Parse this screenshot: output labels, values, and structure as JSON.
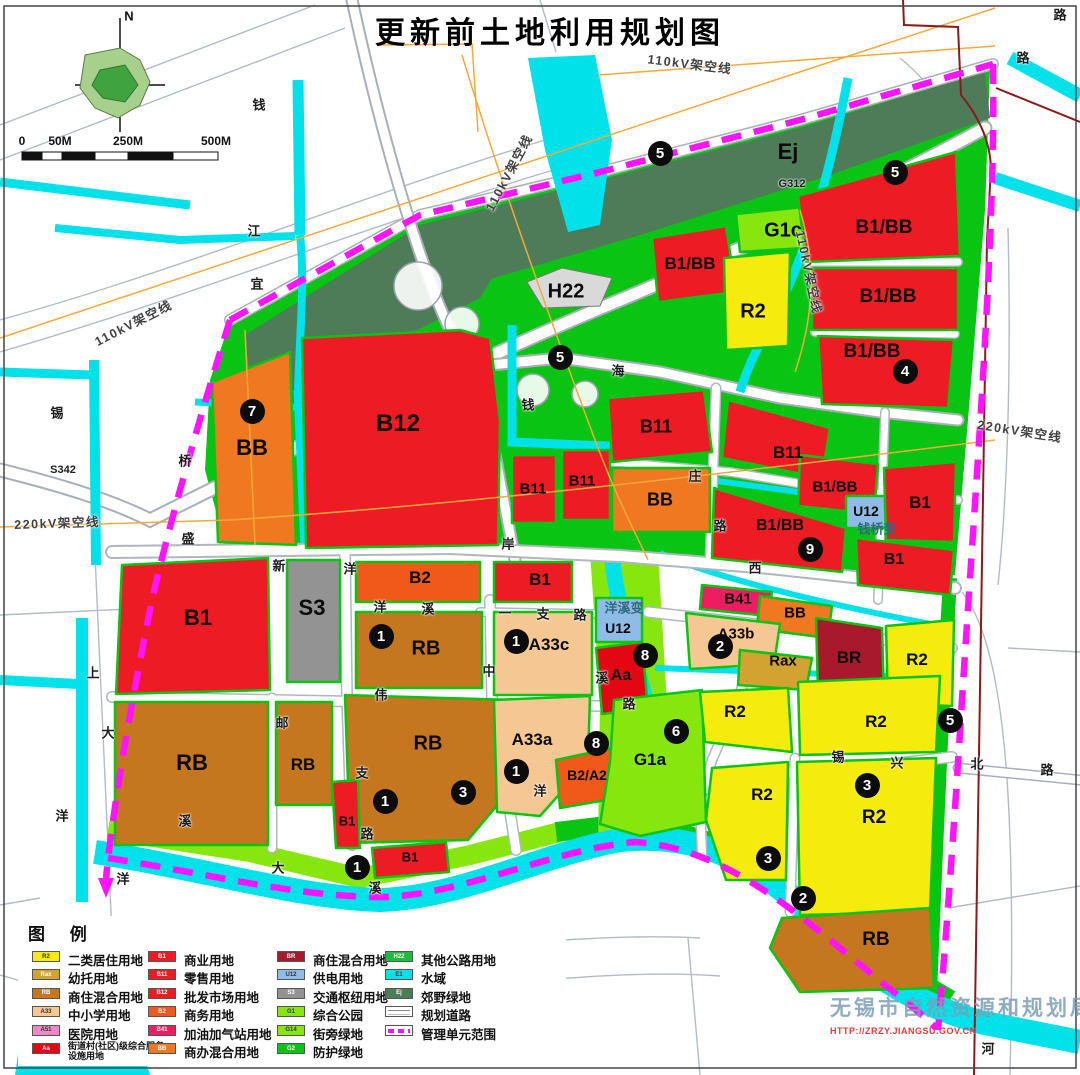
{
  "title": "更新前土地利用规划图",
  "compass": {
    "north_label": "N"
  },
  "scale_bar": {
    "ticks": [
      {
        "t": "0",
        "x": 22
      },
      {
        "t": "50M",
        "x": 60
      },
      {
        "t": "250M",
        "x": 128
      },
      {
        "t": "500M",
        "x": 216
      }
    ]
  },
  "legend": {
    "title": "图 例",
    "columns": [
      [
        {
          "code": "R2",
          "color": "#F5EB0C",
          "tc": "#333",
          "label": "二类居住用地"
        },
        {
          "code": "Rax",
          "color": "#D2A331",
          "tc": "#fff",
          "label": "幼托用地"
        },
        {
          "code": "RB",
          "color": "#C4771E",
          "tc": "#fff",
          "label": "商住混合用地"
        },
        {
          "code": "A33",
          "color": "#F5C793",
          "tc": "#333",
          "label": "中小学用地"
        },
        {
          "code": "A51",
          "color": "#F287C7",
          "tc": "#333",
          "label": "医院用地"
        },
        {
          "code": "Aa",
          "color": "#E30613",
          "tc": "#fff",
          "label": "街道村(社区)级综合服务设施用地",
          "small": true
        }
      ],
      [
        {
          "code": "B1",
          "color": "#ED1C24",
          "tc": "#fff",
          "label": "商业用地"
        },
        {
          "code": "B11",
          "color": "#ED1C24",
          "tc": "#fff",
          "label": "零售用地"
        },
        {
          "code": "B12",
          "color": "#ED1C24",
          "tc": "#fff",
          "label": "批发市场用地"
        },
        {
          "code": "B2",
          "color": "#F1591A",
          "tc": "#fff",
          "label": "商务用地"
        },
        {
          "code": "B41",
          "color": "#EE1D62",
          "tc": "#fff",
          "label": "加油加气站用地"
        },
        {
          "code": "BB",
          "color": "#F07820",
          "tc": "#fff",
          "label": "商办混合用地"
        }
      ],
      [
        {
          "code": "BR",
          "color": "#A8192E",
          "tc": "#fff",
          "label": "商住混合用地"
        },
        {
          "code": "U12",
          "color": "#8FBCE6",
          "tc": "#333",
          "label": "供电用地"
        },
        {
          "code": "S3",
          "color": "#939393",
          "tc": "#fff",
          "label": "交通枢纽用地"
        },
        {
          "code": "G1",
          "color": "#86E60D",
          "tc": "#333",
          "label": "综合公园"
        },
        {
          "code": "G14",
          "color": "#86E60D",
          "tc": "#333",
          "label": "街旁绿地"
        },
        {
          "code": "G2",
          "color": "#0AC414",
          "tc": "#fff",
          "label": "防护绿地"
        }
      ],
      [
        {
          "code": "H22",
          "color": "#1DBE3C",
          "tc": "#fff",
          "label": "其他公路用地"
        },
        {
          "code": "E1",
          "color": "#00E1EA",
          "tc": "#333",
          "label": "水域"
        },
        {
          "code": "Ej",
          "color": "#4E7B58",
          "tc": "#fff",
          "label": "郊野绿地"
        },
        {
          "type": "road",
          "code": "",
          "label": "规划道路"
        },
        {
          "type": "boundary",
          "code": "",
          "label": "管理单元范围"
        }
      ]
    ]
  },
  "map": {
    "zone_labels": [
      {
        "t": "Ej",
        "x": 788,
        "y": 152,
        "s": 22
      },
      {
        "t": "G1c",
        "x": 783,
        "y": 231,
        "s": 20
      },
      {
        "t": "B1/BB",
        "x": 690,
        "y": 264,
        "s": 17
      },
      {
        "t": "R2",
        "x": 753,
        "y": 312,
        "s": 20
      },
      {
        "t": "B1/BB",
        "x": 884,
        "y": 228,
        "s": 19
      },
      {
        "t": "B1/BB",
        "x": 888,
        "y": 297,
        "s": 19
      },
      {
        "t": "B1/BB",
        "x": 872,
        "y": 352,
        "s": 19
      },
      {
        "t": "H22",
        "x": 566,
        "y": 292,
        "s": 20
      },
      {
        "t": "B12",
        "x": 398,
        "y": 424,
        "s": 24
      },
      {
        "t": "BB",
        "x": 252,
        "y": 448,
        "s": 22
      },
      {
        "t": "B11",
        "x": 533,
        "y": 489,
        "s": 15
      },
      {
        "t": "B11",
        "x": 582,
        "y": 481,
        "s": 15
      },
      {
        "t": "B11",
        "x": 656,
        "y": 427,
        "s": 18
      },
      {
        "t": "B11",
        "x": 788,
        "y": 453,
        "s": 17
      },
      {
        "t": "BB",
        "x": 660,
        "y": 500,
        "s": 18
      },
      {
        "t": "B1/BB",
        "x": 835,
        "y": 487,
        "s": 15
      },
      {
        "t": "B1",
        "x": 920,
        "y": 503,
        "s": 17
      },
      {
        "t": "U12",
        "x": 866,
        "y": 511,
        "s": 14
      },
      {
        "t": "钱桥变",
        "x": 877,
        "y": 528,
        "s": 13,
        "c": "#2F6B7E"
      },
      {
        "t": "B1/BB",
        "x": 780,
        "y": 526,
        "s": 16
      },
      {
        "t": "B1",
        "x": 894,
        "y": 560,
        "s": 16
      },
      {
        "t": "B1",
        "x": 198,
        "y": 618,
        "s": 22
      },
      {
        "t": "S3",
        "x": 312,
        "y": 608,
        "s": 22
      },
      {
        "t": "B2",
        "x": 420,
        "y": 578,
        "s": 17
      },
      {
        "t": "B1",
        "x": 540,
        "y": 580,
        "s": 17
      },
      {
        "t": "RB",
        "x": 426,
        "y": 649,
        "s": 20
      },
      {
        "t": "A33c",
        "x": 549,
        "y": 645,
        "s": 17
      },
      {
        "t": "洋溪变",
        "x": 624,
        "y": 607,
        "s": 13,
        "c": "#2F6B7E"
      },
      {
        "t": "U12",
        "x": 618,
        "y": 628,
        "s": 14
      },
      {
        "t": "Aa",
        "x": 621,
        "y": 676,
        "s": 16
      },
      {
        "t": "B41",
        "x": 738,
        "y": 599,
        "s": 15
      },
      {
        "t": "BB",
        "x": 795,
        "y": 613,
        "s": 15
      },
      {
        "t": "A33b",
        "x": 736,
        "y": 634,
        "s": 15
      },
      {
        "t": "Rax",
        "x": 783,
        "y": 661,
        "s": 15
      },
      {
        "t": "BR",
        "x": 849,
        "y": 658,
        "s": 17
      },
      {
        "t": "R2",
        "x": 917,
        "y": 660,
        "s": 17
      },
      {
        "t": "RB",
        "x": 192,
        "y": 763,
        "s": 22
      },
      {
        "t": "RB",
        "x": 303,
        "y": 765,
        "s": 17
      },
      {
        "t": "RB",
        "x": 428,
        "y": 744,
        "s": 20
      },
      {
        "t": "A33a",
        "x": 532,
        "y": 740,
        "s": 17
      },
      {
        "t": "B2/A2",
        "x": 587,
        "y": 775,
        "s": 14
      },
      {
        "t": "G1a",
        "x": 650,
        "y": 760,
        "s": 17
      },
      {
        "t": "B1",
        "x": 347,
        "y": 821,
        "s": 13
      },
      {
        "t": "B1",
        "x": 410,
        "y": 857,
        "s": 13
      },
      {
        "t": "R2",
        "x": 735,
        "y": 712,
        "s": 17
      },
      {
        "t": "R2",
        "x": 876,
        "y": 722,
        "s": 17
      },
      {
        "t": "R2",
        "x": 762,
        "y": 795,
        "s": 17
      },
      {
        "t": "R2",
        "x": 874,
        "y": 818,
        "s": 19
      },
      {
        "t": "RB",
        "x": 876,
        "y": 940,
        "s": 19
      }
    ],
    "road_labels": [
      {
        "t": "路",
        "x": 1060,
        "y": 14
      },
      {
        "t": "路",
        "x": 1023,
        "y": 57
      },
      {
        "t": "钱",
        "x": 259,
        "y": 104
      },
      {
        "t": "江",
        "x": 254,
        "y": 230
      },
      {
        "t": "宜",
        "x": 257,
        "y": 283
      },
      {
        "t": "G312",
        "x": 792,
        "y": 184,
        "s": 11
      },
      {
        "t": "海",
        "x": 618,
        "y": 370
      },
      {
        "t": "钱",
        "x": 528,
        "y": 404
      },
      {
        "t": "锡",
        "x": 57,
        "y": 412
      },
      {
        "t": "S342",
        "x": 63,
        "y": 470,
        "s": 11
      },
      {
        "t": "桥",
        "x": 185,
        "y": 460
      },
      {
        "t": "盛",
        "x": 188,
        "y": 538
      },
      {
        "t": "岸",
        "x": 508,
        "y": 543
      },
      {
        "t": "西",
        "x": 755,
        "y": 567
      },
      {
        "t": "庄",
        "x": 695,
        "y": 475
      },
      {
        "t": "路",
        "x": 720,
        "y": 525
      },
      {
        "t": "新",
        "x": 279,
        "y": 565
      },
      {
        "t": "洋",
        "x": 350,
        "y": 568
      },
      {
        "t": "洋",
        "x": 380,
        "y": 606
      },
      {
        "t": "溪",
        "x": 428,
        "y": 608
      },
      {
        "t": "一",
        "x": 505,
        "y": 612
      },
      {
        "t": "支",
        "x": 543,
        "y": 613
      },
      {
        "t": "路",
        "x": 580,
        "y": 614
      },
      {
        "t": "中",
        "x": 489,
        "y": 670
      },
      {
        "t": "伟",
        "x": 381,
        "y": 694
      },
      {
        "t": "邮",
        "x": 282,
        "y": 722
      },
      {
        "t": "溪",
        "x": 602,
        "y": 677
      },
      {
        "t": "路",
        "x": 629,
        "y": 703
      },
      {
        "t": "支",
        "x": 362,
        "y": 772
      },
      {
        "t": "路",
        "x": 367,
        "y": 833
      },
      {
        "t": "洋",
        "x": 540,
        "y": 790
      },
      {
        "t": "上",
        "x": 93,
        "y": 672
      },
      {
        "t": "大",
        "x": 108,
        "y": 732
      },
      {
        "t": "洋",
        "x": 62,
        "y": 815
      },
      {
        "t": "溪",
        "x": 185,
        "y": 820
      },
      {
        "t": "洋",
        "x": 123,
        "y": 878
      },
      {
        "t": "大",
        "x": 278,
        "y": 867
      },
      {
        "t": "溪",
        "x": 375,
        "y": 887
      },
      {
        "t": "锡",
        "x": 838,
        "y": 756
      },
      {
        "t": "兴",
        "x": 897,
        "y": 762
      },
      {
        "t": "北",
        "x": 977,
        "y": 763
      },
      {
        "t": "路",
        "x": 1047,
        "y": 769
      },
      {
        "t": "河",
        "x": 988,
        "y": 1048
      }
    ],
    "power_labels": [
      {
        "t": "110kV架空线",
        "x": 690,
        "y": 63,
        "rot": 7
      },
      {
        "t": "110kV架空线",
        "x": 508,
        "y": 172,
        "rot": -62
      },
      {
        "t": "110kV架空线",
        "x": 133,
        "y": 322,
        "rot": -27
      },
      {
        "t": "110kV架空线",
        "x": 810,
        "y": 272,
        "rot": 78
      },
      {
        "t": "220kV架空线",
        "x": 57,
        "y": 522,
        "rot": -2
      },
      {
        "t": "220kV架空线",
        "x": 1020,
        "y": 430,
        "rot": 9
      }
    ],
    "markers": [
      {
        "n": 5,
        "x": 660,
        "y": 153
      },
      {
        "n": 5,
        "x": 895,
        "y": 172
      },
      {
        "n": 5,
        "x": 560,
        "y": 357
      },
      {
        "n": 4,
        "x": 905,
        "y": 371
      },
      {
        "n": 7,
        "x": 252,
        "y": 411
      },
      {
        "n": 9,
        "x": 810,
        "y": 549
      },
      {
        "n": 8,
        "x": 645,
        "y": 655
      },
      {
        "n": 2,
        "x": 720,
        "y": 646
      },
      {
        "n": 6,
        "x": 676,
        "y": 731
      },
      {
        "n": 8,
        "x": 596,
        "y": 743
      },
      {
        "n": 1,
        "x": 381,
        "y": 636
      },
      {
        "n": 1,
        "x": 516,
        "y": 641
      },
      {
        "n": 1,
        "x": 385,
        "y": 801
      },
      {
        "n": 3,
        "x": 463,
        "y": 792
      },
      {
        "n": 1,
        "x": 516,
        "y": 771
      },
      {
        "n": 1,
        "x": 357,
        "y": 867
      },
      {
        "n": 5,
        "x": 950,
        "y": 720
      },
      {
        "n": 3,
        "x": 867,
        "y": 785
      },
      {
        "n": 3,
        "x": 768,
        "y": 858
      },
      {
        "n": 2,
        "x": 803,
        "y": 898
      }
    ]
  },
  "watermark": {
    "agency": "无锡市自然资源和规划局",
    "url": "HTTP://ZRZY.JIANGSU.GOV.CN"
  }
}
